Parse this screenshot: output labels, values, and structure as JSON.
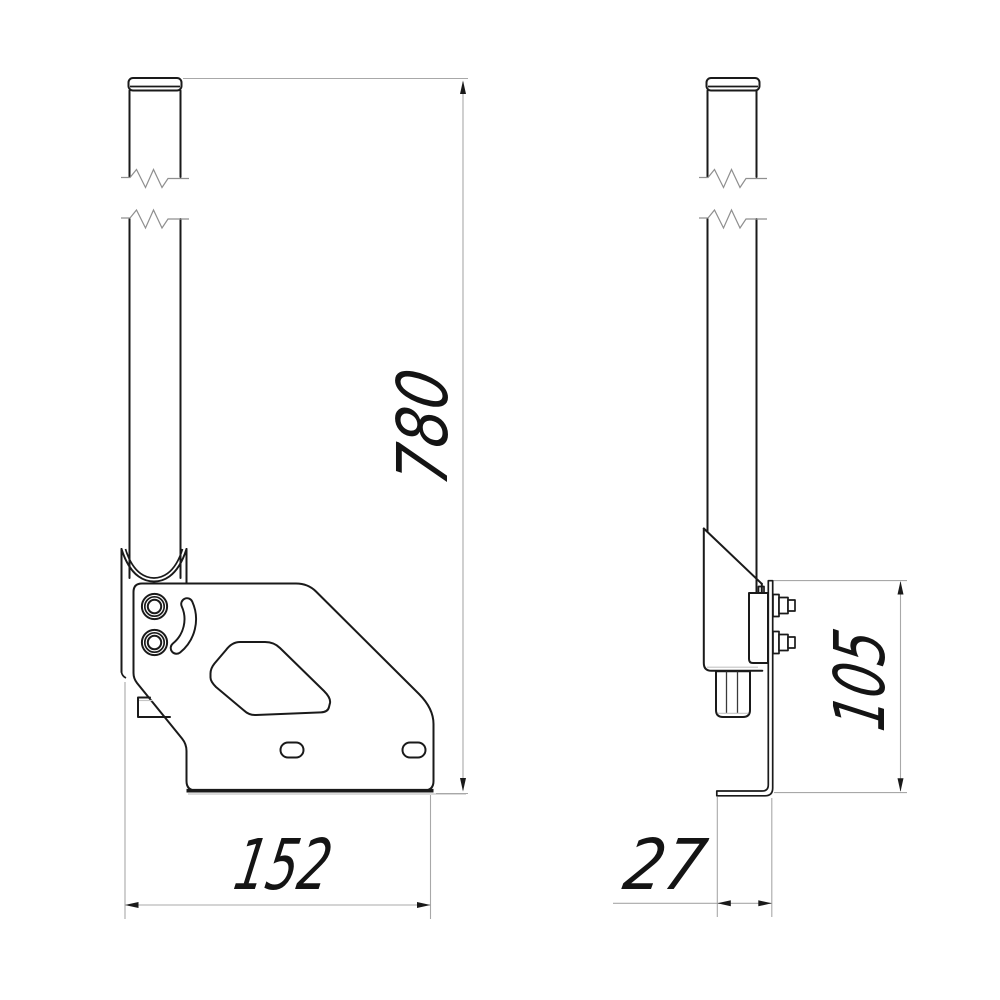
{
  "drawing": {
    "background_color": "#ffffff",
    "outline_color": "#1a1a1a",
    "dimension_line_color": "#a8a8a8",
    "text_color": "#141414",
    "dimensions": {
      "mast_height": "780",
      "base_width": "152",
      "plate_height": "105",
      "flange_depth": "27"
    }
  }
}
